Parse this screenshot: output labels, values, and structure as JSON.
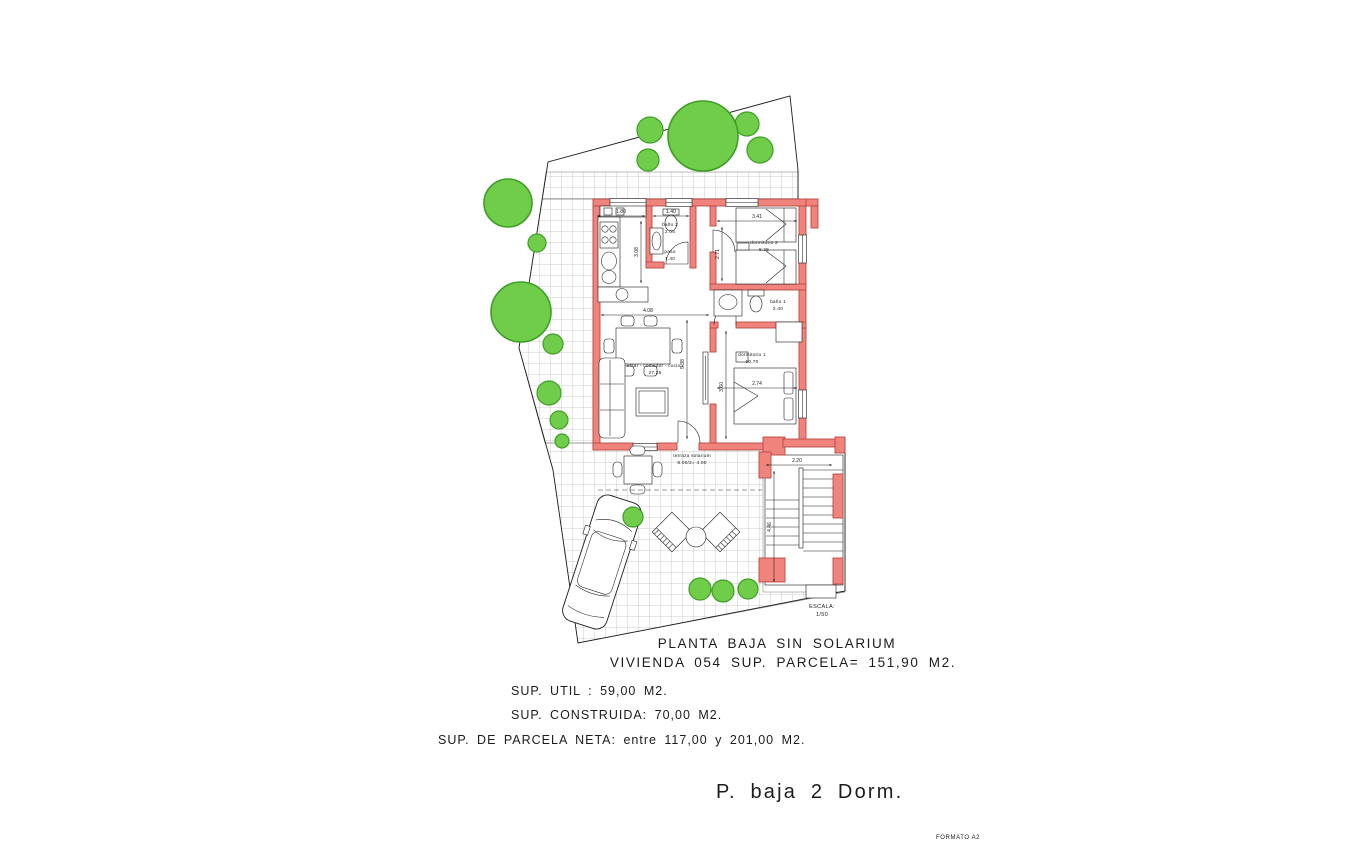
{
  "colors": {
    "wall": "#f0837c",
    "wall_stroke": "#b94a44",
    "tree": "#6fcd49",
    "tree_stroke": "#3f9e26",
    "line": "#1c1c1c",
    "grid": "#8a8a8a"
  },
  "title_block": {
    "line1": "PLANTA BAJA SIN SOLARIUM",
    "line2": "VIVIENDA 054 SUP. PARCELA= 151,90 M2."
  },
  "areas": {
    "util": "SUP. UTIL : 59,00 M2.",
    "construida": "SUP. CONSTRUIDA: 70,00 M2.",
    "parcela_neta": "SUP. DE PARCELA NETA: entre 117,00 y 201,00 M2."
  },
  "footer": {
    "plan_name": "P. baja 2 Dorm.",
    "format": "FORMATO A2"
  },
  "scale": {
    "label": "ESCALA:",
    "value": "1/50"
  },
  "rooms": {
    "living": {
      "name": "estar - comedor - cocina",
      "area": "27.25"
    },
    "dorm1": {
      "name": "dormitorio 1",
      "area": "10.70"
    },
    "dorm2": {
      "name": "dormitorio 2",
      "area": "8.25"
    },
    "bath1": {
      "name": "baño 1",
      "area": "2.40"
    },
    "bath2": {
      "name": "baño 2",
      "area": "2.05"
    },
    "paso": {
      "name": "paso",
      "area": "1.40"
    },
    "terrace": {
      "name": "terraza solarium",
      "area": "8.00/2= 4.00"
    }
  },
  "dims": {
    "kitchen_w": "1.80",
    "kitchen_d": "3.08",
    "bath2_w": "1.40",
    "dorm2_w": "3.41",
    "dorm2_d": "2.71",
    "living_w": "4.08",
    "living_d": "5.38",
    "dorm1_w": "2.74",
    "dorm1_d": "3.60",
    "stair_w": "2.20",
    "stair_d": "4.46"
  }
}
